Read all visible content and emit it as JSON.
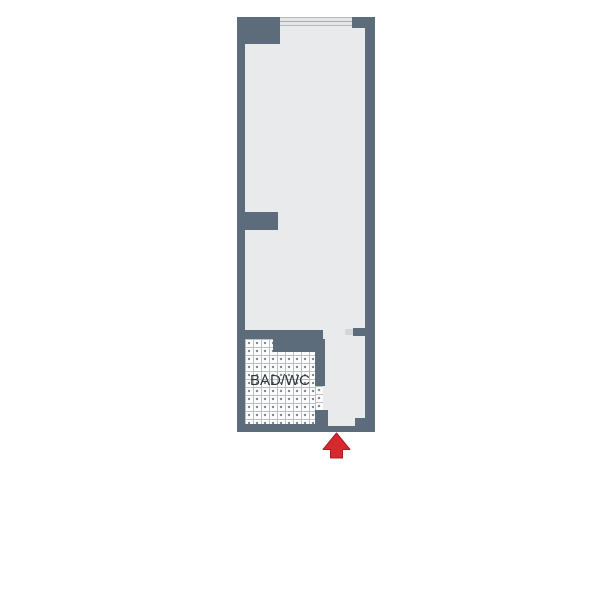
{
  "floorplan": {
    "rooms": {
      "bathroom_label": "BAD/WC"
    },
    "icons": {
      "entrance_arrow": "up-arrow"
    },
    "colors": {
      "wall": "#5d6c7b",
      "floor": "#e9eaeb",
      "tile_background": "#fdfdfd",
      "tile_grid_line": "#bcc0c3",
      "window_fill": "#e4e6e7",
      "window_center_line": "#a9aeb1",
      "arrow_red": "#d7282f",
      "arrow_outline": "#a81e24"
    }
  }
}
